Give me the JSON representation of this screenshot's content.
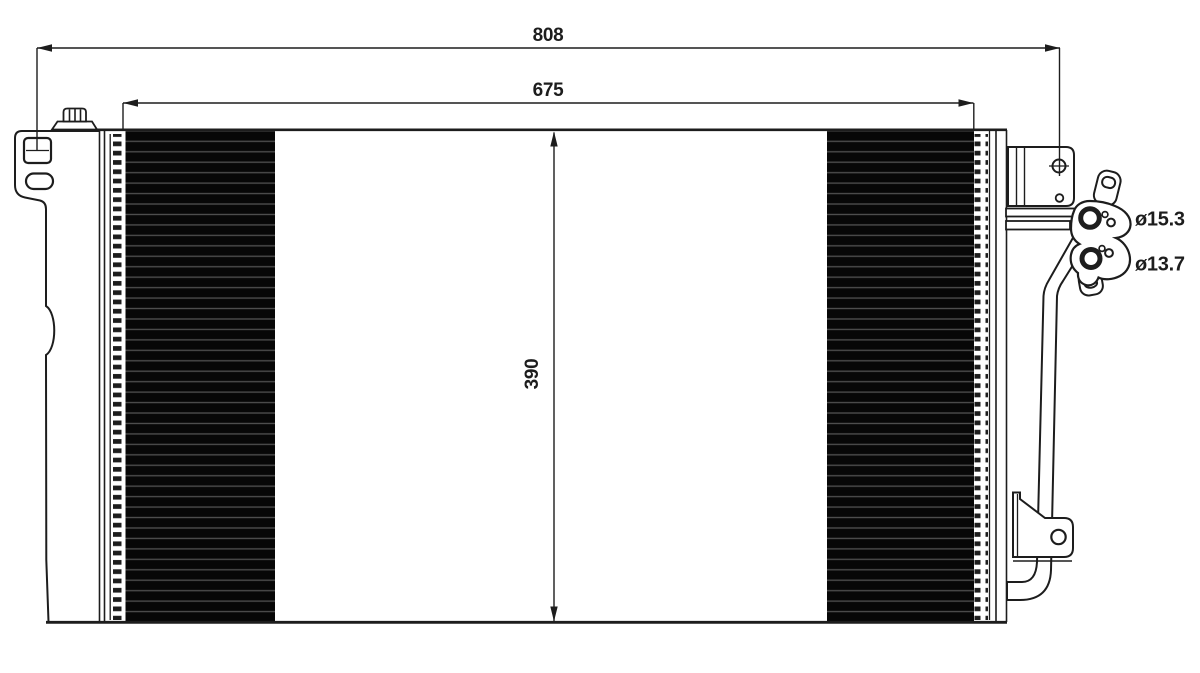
{
  "drawing": {
    "type": "condenser dimensional diagram",
    "labels": {
      "overall_width": "808",
      "core_width": "675",
      "core_height": "390",
      "port_top_diameter": "ø15.3",
      "port_bottom_diameter": "ø13.7"
    }
  },
  "colors": {
    "background": "#ffffff",
    "line": "#1d1d1d",
    "fin_fill": "#070707",
    "fin_stripe": "#4e4e4e"
  }
}
